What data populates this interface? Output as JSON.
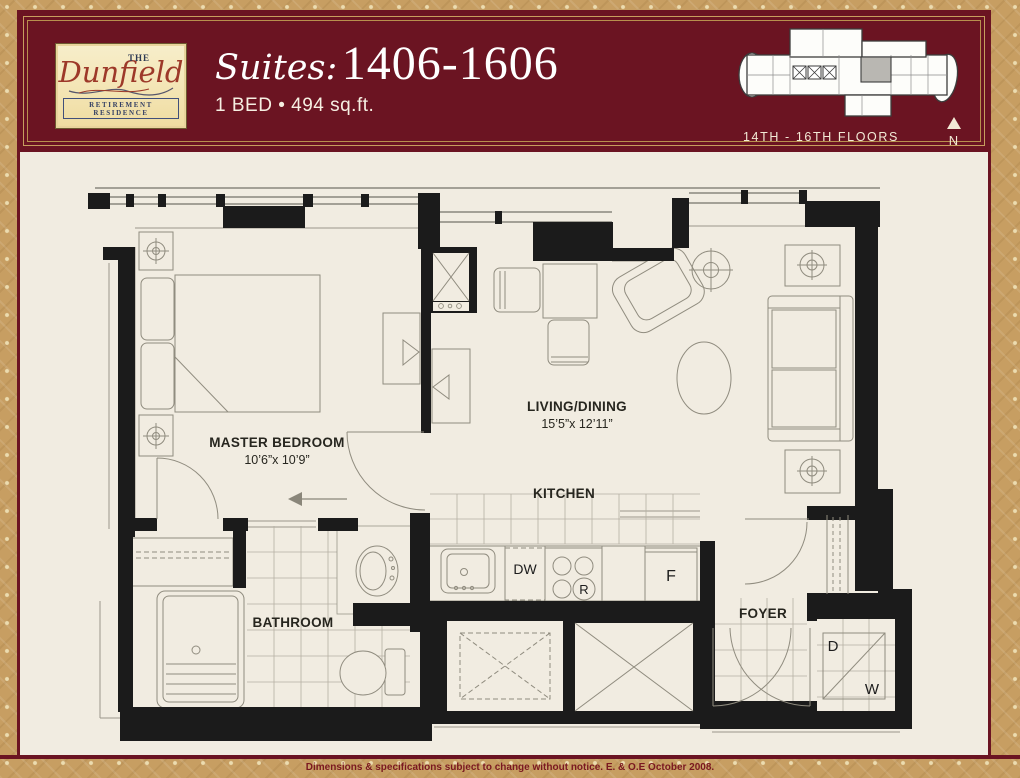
{
  "colors": {
    "maroon": "#6b1422",
    "gold": "#c79e62",
    "cream": "#f1ece1",
    "wall_black": "#1b1b1b",
    "keyplan_highlight": "#b9b7b2"
  },
  "header": {
    "logo": {
      "the": "THE",
      "name": "Dunfield",
      "tagline": "RETIREMENT RESIDENCE"
    },
    "title_script": "Suites:",
    "title_numbers": "1406-1606",
    "subtitle": "1 BED • 494 sq.ft.",
    "keyplan_caption": "14TH - 16TH FLOORS",
    "north_label": "N"
  },
  "plan": {
    "master_bedroom": {
      "name": "MASTER BEDROOM",
      "dims": "10’6”x 10’9”"
    },
    "living_dining": {
      "name": "LIVING/DINING",
      "dims": "15’5”x 12’11”"
    },
    "kitchen_label": "KITCHEN",
    "bathroom_label": "BATHROOM",
    "foyer_label": "FOYER",
    "appliances": {
      "dishwasher": "DW",
      "range": "R",
      "fridge": "F",
      "dryer": "D",
      "washer": "W"
    }
  },
  "footer": {
    "disclaimer": "Dimensions & specifications subject to change without notice. E. & O.E October 2008."
  }
}
